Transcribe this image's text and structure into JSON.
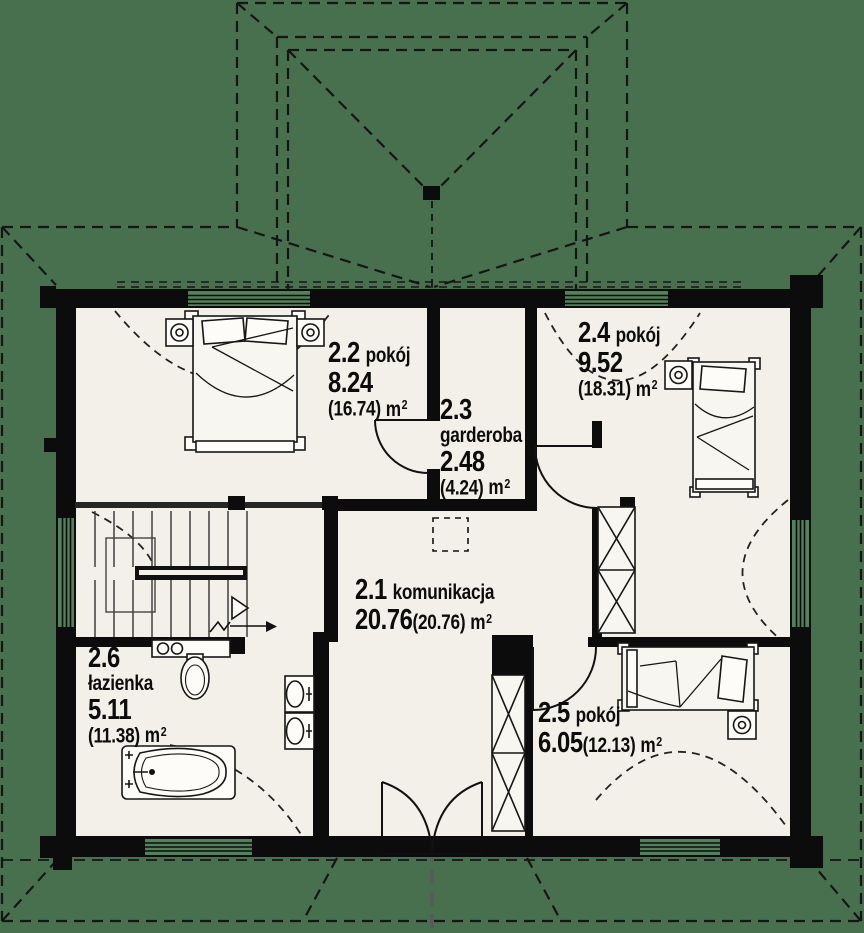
{
  "drawing": {
    "kind": "floor-plan",
    "language": "pl"
  },
  "rooms": [
    {
      "number": "2.1",
      "name": "komunikacja",
      "area": "20.76",
      "area_floor": "(20.76)"
    },
    {
      "number": "2.2",
      "name": "pokój",
      "area": "8.24",
      "area_floor": "(16.74)"
    },
    {
      "number": "2.3",
      "name": "garderoba",
      "area": "2.48",
      "area_floor": "(4.24)"
    },
    {
      "number": "2.4",
      "name": "pokój",
      "area": "9.52",
      "area_floor": "(18.31)"
    },
    {
      "number": "2.5",
      "name": "pokój",
      "area": "6.05",
      "area_floor": "(12.13)"
    },
    {
      "number": "2.6",
      "name": "łazienka",
      "area": "5.11",
      "area_floor": "(11.38)"
    }
  ],
  "units": {
    "area": "m",
    "sup": "2"
  },
  "colors": {
    "background": "#48704E",
    "floor": "#f3f0e9",
    "wall": "#0c0c0c",
    "window_glass": "#53815b",
    "line": "#1a1a1a",
    "axis_line": "#5a5a5a",
    "furniture_fill": "#f8f6f0"
  }
}
